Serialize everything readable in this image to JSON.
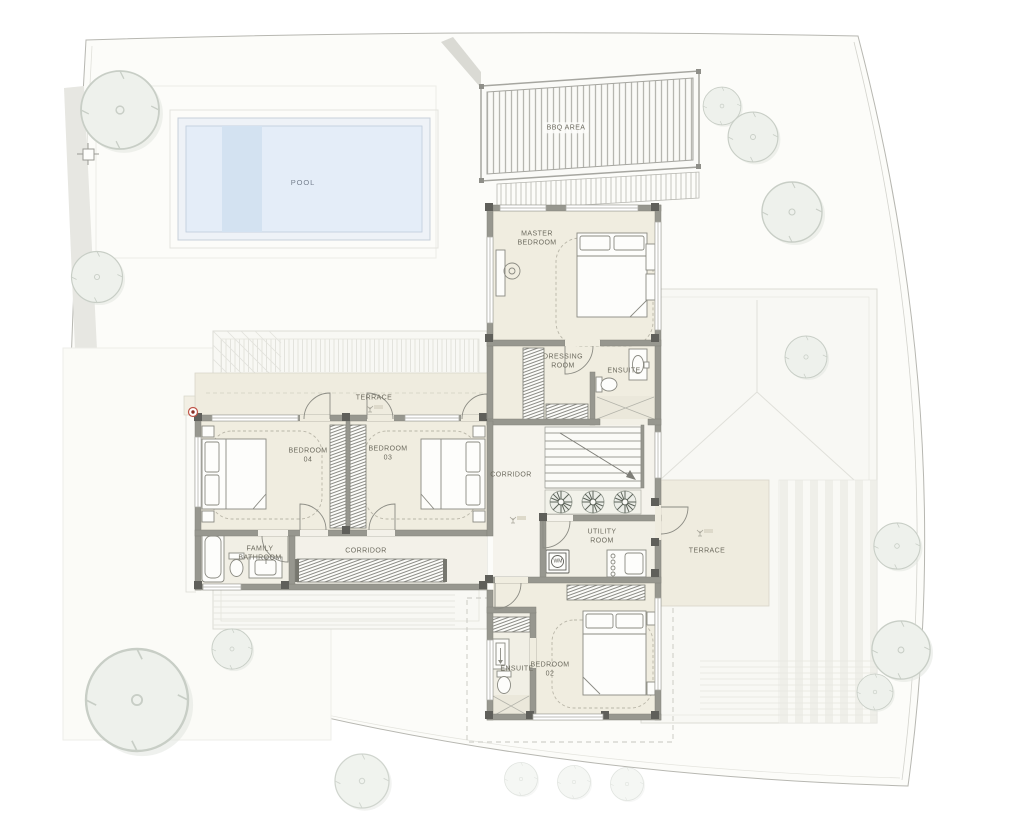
{
  "plan_type": "first-floor-plan",
  "colors": {
    "wall": "#97978f",
    "wall_dark": "#5f5f5a",
    "floor_room": "#f0ede0",
    "floor_circulation": "#f5f3ec",
    "floor_wet": "#f1efe5",
    "terrace": "#efecdf",
    "pool_water": "#e4edf8",
    "pool_step": "#d3e2f1",
    "tree_fill": "#eef1ec",
    "roof_line": "#dbdbd5",
    "label_text": "#6c6a5e",
    "marker_red": "#c05548"
  },
  "rooms": {
    "pool": {
      "label": "POOL"
    },
    "bbq_area": {
      "label": "BBQ AREA"
    },
    "master_bedroom": {
      "label": "MASTER\nBEDROOM"
    },
    "dressing_room": {
      "label": "DRESSING\nROOM"
    },
    "master_ensuite": {
      "label": "ENSUITE"
    },
    "corridor_upper": {
      "label": "CORRIDOR"
    },
    "bedroom_04": {
      "label": "BEDROOM\n04"
    },
    "bedroom_03": {
      "label": "BEDROOM\n03"
    },
    "terrace_west": {
      "label": "TERRACE"
    },
    "corridor_west": {
      "label": "CORRIDOR"
    },
    "family_bathroom": {
      "label": "FAMILY\nBATHROOM"
    },
    "utility_room": {
      "label": "UTILITY\nROOM"
    },
    "terrace_east": {
      "label": "TERRACE"
    },
    "ensuite_02": {
      "label": "ENSUITE"
    },
    "bedroom_02": {
      "label": "BEDROOM\n02"
    }
  },
  "fixtures": {
    "washing_machine": "WM"
  }
}
